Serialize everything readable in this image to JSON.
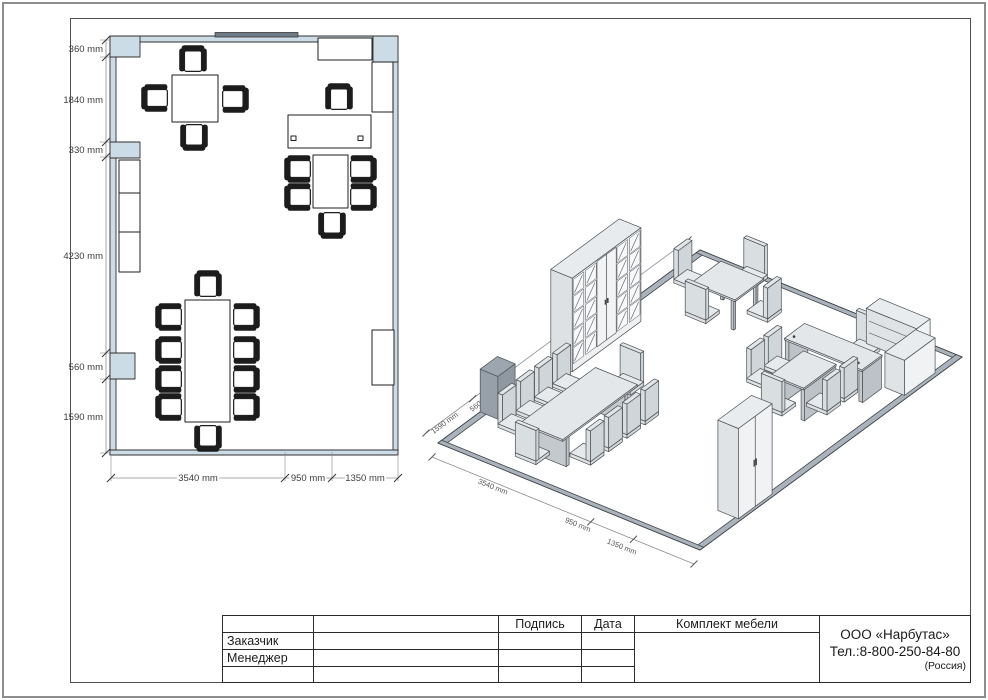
{
  "sheet": {
    "plan_dims_left": [
      "360 mm",
      "1840 mm",
      "330 mm",
      "4230 mm",
      "560 mm",
      "1590 mm"
    ],
    "plan_dims_bottom": [
      "3540 mm",
      "950 mm",
      "1350 mm"
    ],
    "iso_dims_wall": [
      "1590 mm",
      "560 mm",
      "4230 mm",
      "1840 mm",
      "360 mm"
    ],
    "iso_dims_floor": [
      "3540 mm",
      "950 mm",
      "1350 mm"
    ]
  },
  "title_block": {
    "customer_label": "Заказчик",
    "manager_label": "Менеджер",
    "signature_label": "Подпись",
    "date_label": "Дата",
    "project_label": "Комплект мебели",
    "company": "ООО «Нарбутас»",
    "phone": "Тел.:8-800-250-84-80",
    "country": "(Россия)"
  },
  "colors": {
    "wall_fill": "#ccdce6",
    "wall_window": "#6e7a85",
    "iso_strip": "#aab3bb",
    "dim_text": "#4a4a4a"
  }
}
